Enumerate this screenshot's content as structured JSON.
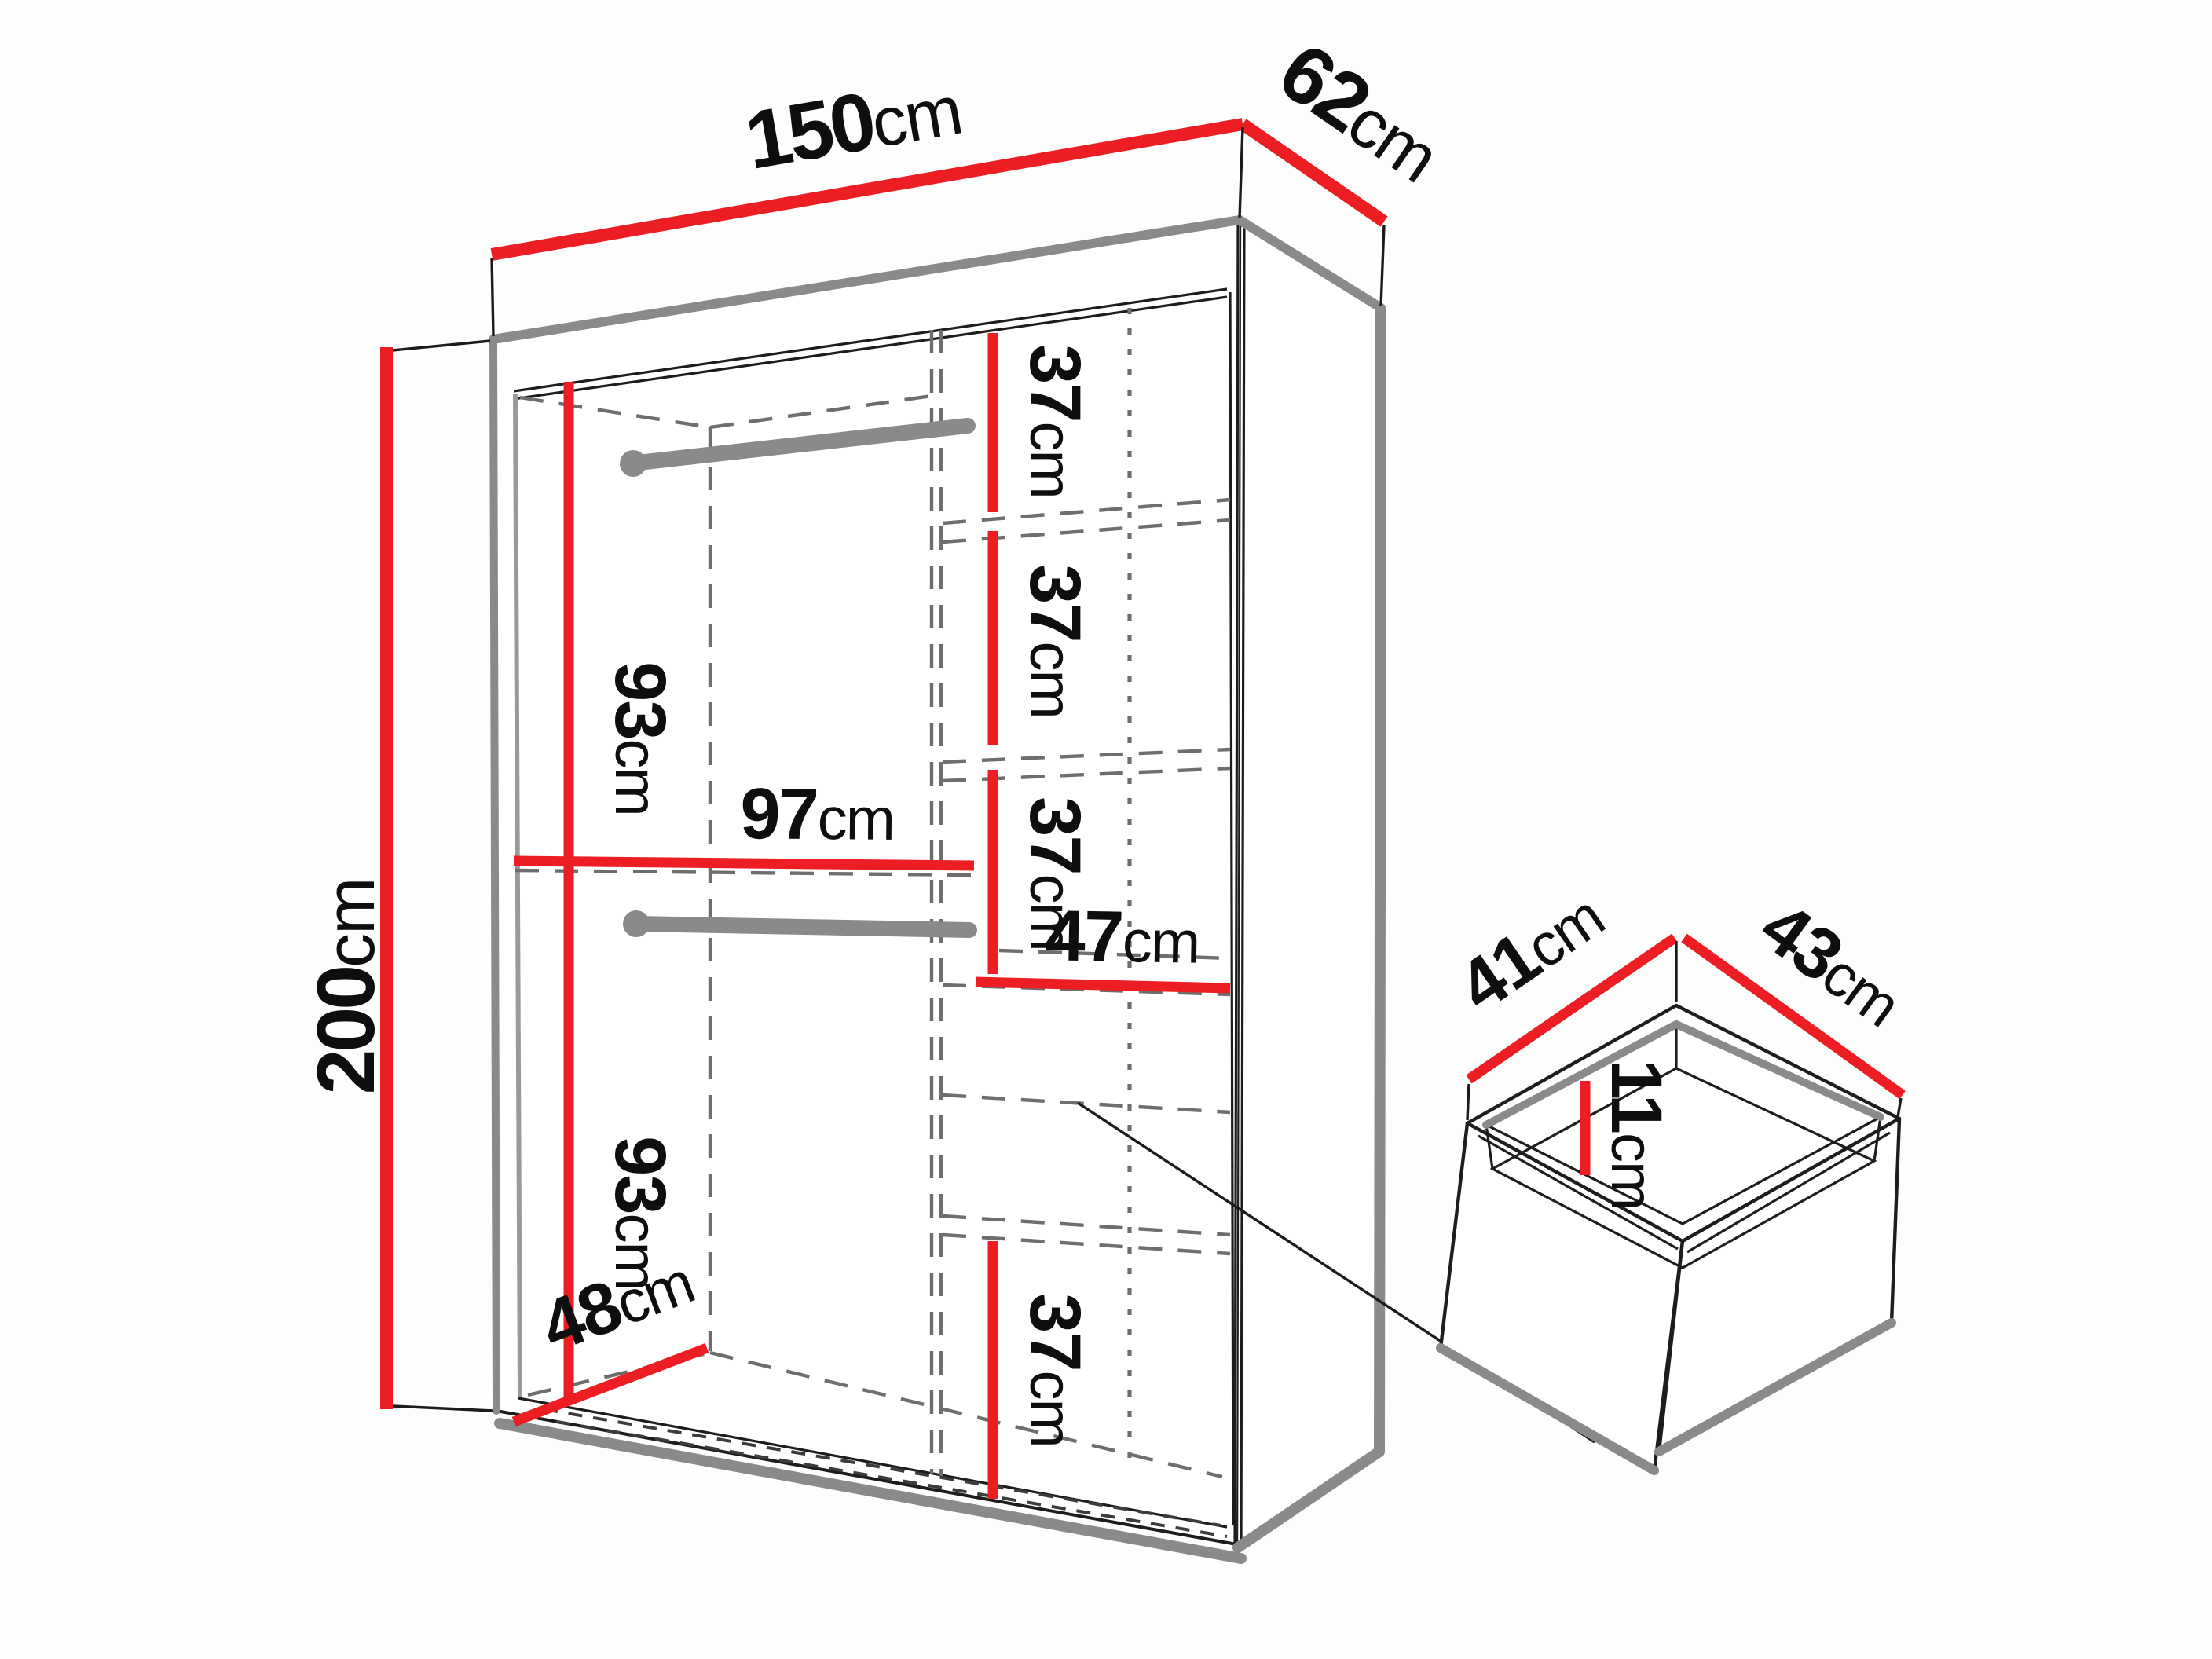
{
  "diagram": {
    "kind": "furniture-dimension-diagram",
    "subject": "wardrobe interior dimensions with drawer detail",
    "colors": {
      "dimension_line": "#EC1E24",
      "panel_edge": "#8A8A8A",
      "outline": "#1D1D1B",
      "hidden_line": "#6E6E6E",
      "background": "#FDFDFD"
    },
    "wardrobe": {
      "width": {
        "value": "150",
        "unit": "cm"
      },
      "depth": {
        "value": "62",
        "unit": "cm"
      },
      "height": {
        "value": "200",
        "unit": "cm"
      },
      "upper_hanging_height": {
        "value": "93",
        "unit": "cm"
      },
      "lower_hanging_height": {
        "value": "93",
        "unit": "cm"
      },
      "hanging_section_width": {
        "value": "97",
        "unit": "cm"
      },
      "shelf_spacings": [
        {
          "value": "37",
          "unit": "cm"
        },
        {
          "value": "37",
          "unit": "cm"
        },
        {
          "value": "37",
          "unit": "cm"
        },
        {
          "value": "37",
          "unit": "cm"
        }
      ],
      "shelf_section_width": {
        "value": "47",
        "unit": "cm"
      },
      "internal_depth": {
        "value": "48",
        "unit": "cm"
      }
    },
    "drawer": {
      "internal_depth": {
        "value": "41",
        "unit": "cm"
      },
      "internal_width": {
        "value": "43",
        "unit": "cm"
      },
      "internal_height": {
        "value": "11",
        "unit": "cm"
      }
    }
  }
}
